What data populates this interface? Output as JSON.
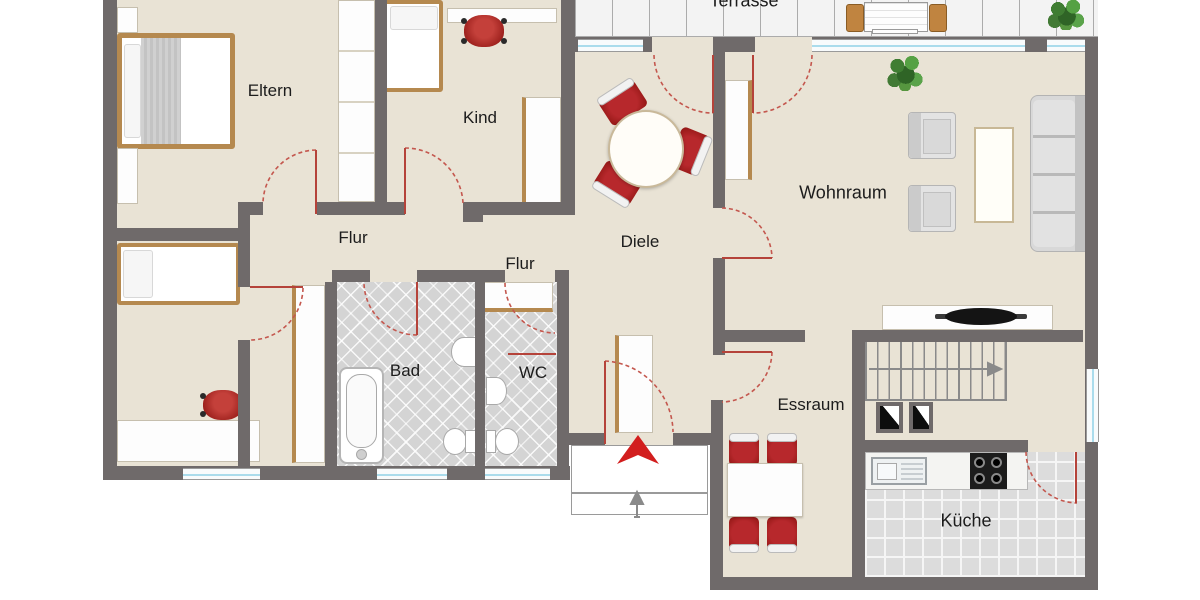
{
  "plan": {
    "type": "apartment-floorplan",
    "language": "de",
    "rooms": {
      "eltern": {
        "label": "Eltern"
      },
      "kind_top": {
        "label": "Kind"
      },
      "kind_bottom": {
        "label": "Kind"
      },
      "flur_upper": {
        "label": "Flur"
      },
      "flur_lower": {
        "label": "Flur"
      },
      "diele": {
        "label": "Diele"
      },
      "wohnraum": {
        "label": "Wohnraum"
      },
      "bad": {
        "label": "Bad"
      },
      "wc": {
        "label": "WC"
      },
      "essraum": {
        "label": "Essraum"
      },
      "kueche": {
        "label": "Küche"
      },
      "terrasse": {
        "label": "Terrasse"
      }
    },
    "colors": {
      "wall": "#6f6a6a",
      "floor": "#e9e3d5",
      "accent_red": "#a91e22",
      "door_arc_red": "#c4574e",
      "wood_brown": "#b5894f",
      "bath_tile": "#d4d4d4",
      "kitchen_tile": "#dcdcdc",
      "window_glass": "#aadcec",
      "plant_green": "#4f9140"
    }
  }
}
